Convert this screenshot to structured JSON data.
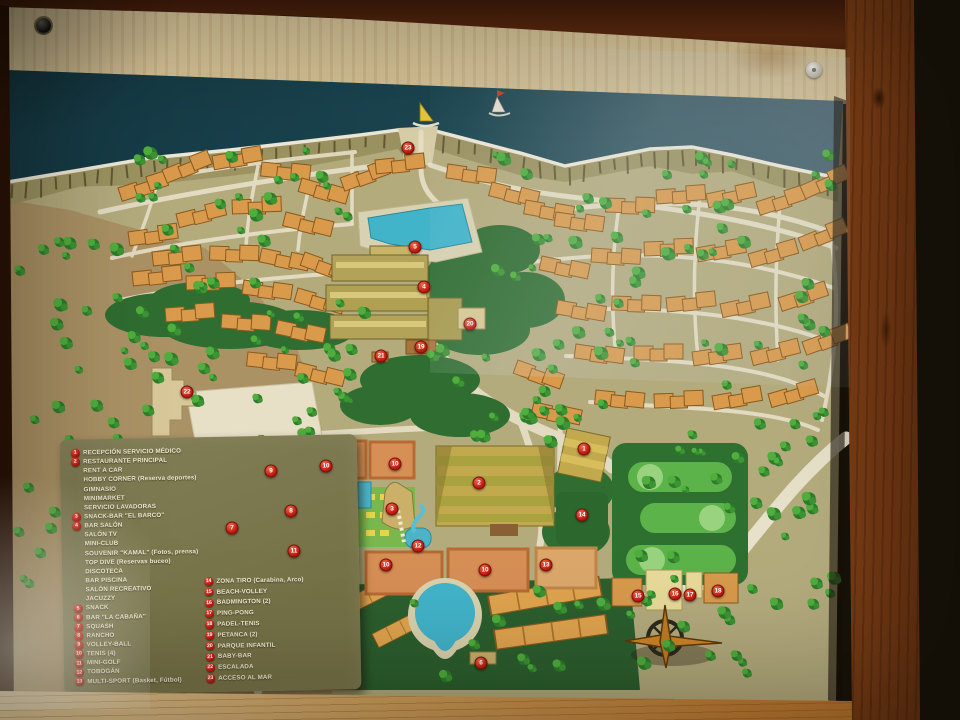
{
  "board": {
    "type": "resort-site-map-sign",
    "colors": {
      "sea_teal": "#1c4652",
      "land_olive": "#b4ab7d",
      "legend_olive": "#7a774f",
      "marker_red": "#c21d10",
      "building_orange": "#d99a4c",
      "pool_blue": "#42b4ca",
      "golf_green": "#2d7030",
      "wood_brown": "#a35d22"
    },
    "icons": [
      {
        "name": "compass-rose-icon"
      },
      {
        "name": "sailboat-yellow-icon"
      },
      {
        "name": "sailboat-white-icon"
      }
    ]
  },
  "legend": {
    "column1": [
      {
        "num": "1",
        "label": "RECEPCIÓN SERVICIO MÉDICO"
      },
      {
        "num": "2",
        "label": "RESTAURANTE PRINCIPAL"
      },
      {
        "num": "",
        "label": "RENT A CAR"
      },
      {
        "num": "",
        "label": "HOBBY CORNER (Reserva deportes)"
      },
      {
        "num": "",
        "label": "GIMNASIO"
      },
      {
        "num": "",
        "label": "MINIMARKET"
      },
      {
        "num": "",
        "label": "SERVICIO LAVADORAS"
      },
      {
        "num": "3",
        "label": "SNACK-BAR \"EL BARCO\""
      },
      {
        "num": "4",
        "label": "BAR SALÓN"
      },
      {
        "num": "",
        "label": "SALÓN TV"
      },
      {
        "num": "",
        "label": "MINI-CLUB"
      },
      {
        "num": "",
        "label": "SOUVENIR \"KAMAL\" (Fotos, prensa)"
      },
      {
        "num": "",
        "label": "TOP DIVE (Reservas buceo)"
      },
      {
        "num": "",
        "label": "DISCOTECA"
      },
      {
        "num": "",
        "label": "BAR PISCINA"
      },
      {
        "num": "",
        "label": "SALÓN RECREATIVO"
      },
      {
        "num": "",
        "label": "JACUZZY"
      },
      {
        "num": "5",
        "label": "SNACK"
      },
      {
        "num": "6",
        "label": "BAR \"LA CABAÑA\""
      },
      {
        "num": "7",
        "label": "SQUASH"
      },
      {
        "num": "8",
        "label": "RANCHO"
      },
      {
        "num": "9",
        "label": "VOLLEY-BALL"
      },
      {
        "num": "10",
        "label": "TENIS (4)"
      },
      {
        "num": "11",
        "label": "MINI-GOLF"
      },
      {
        "num": "12",
        "label": "TOBOGÁN"
      },
      {
        "num": "13",
        "label": "MULTI-SPORT (Basket, Fútbol)"
      }
    ],
    "column2": [
      {
        "num": "14",
        "label": "ZONA TIRO (Carabina, Arco)"
      },
      {
        "num": "15",
        "label": "BEACH-VOLLEY"
      },
      {
        "num": "16",
        "label": "BADMINGTON (2)"
      },
      {
        "num": "17",
        "label": "PING-PONG"
      },
      {
        "num": "18",
        "label": "PADEL-TENIS"
      },
      {
        "num": "19",
        "label": "PETANCA (2)"
      },
      {
        "num": "20",
        "label": "PARQUE INFANTIL"
      },
      {
        "num": "21",
        "label": "BABY-BAR"
      },
      {
        "num": "22",
        "label": "ESCALADA"
      },
      {
        "num": "23",
        "label": "ACCESO AL MAR"
      }
    ]
  },
  "map": {
    "markers": [
      {
        "num": "23",
        "x": 408,
        "y": 148
      },
      {
        "num": "5",
        "x": 415,
        "y": 247
      },
      {
        "num": "4",
        "x": 424,
        "y": 287
      },
      {
        "num": "20",
        "x": 470,
        "y": 324
      },
      {
        "num": "19",
        "x": 421,
        "y": 347
      },
      {
        "num": "21",
        "x": 381,
        "y": 356
      },
      {
        "num": "22",
        "x": 187,
        "y": 392
      },
      {
        "num": "1",
        "x": 584,
        "y": 449
      },
      {
        "num": "2",
        "x": 479,
        "y": 483
      },
      {
        "num": "14",
        "x": 582,
        "y": 515
      },
      {
        "num": "9",
        "x": 271,
        "y": 471
      },
      {
        "num": "10",
        "x": 326,
        "y": 466
      },
      {
        "num": "10",
        "x": 395,
        "y": 464
      },
      {
        "num": "7",
        "x": 232,
        "y": 528
      },
      {
        "num": "8",
        "x": 291,
        "y": 511
      },
      {
        "num": "3",
        "x": 392,
        "y": 509
      },
      {
        "num": "11",
        "x": 294,
        "y": 551
      },
      {
        "num": "12",
        "x": 418,
        "y": 546
      },
      {
        "num": "10",
        "x": 386,
        "y": 565
      },
      {
        "num": "10",
        "x": 485,
        "y": 570
      },
      {
        "num": "13",
        "x": 546,
        "y": 565
      },
      {
        "num": "15",
        "x": 638,
        "y": 596
      },
      {
        "num": "16",
        "x": 675,
        "y": 594
      },
      {
        "num": "17",
        "x": 690,
        "y": 595
      },
      {
        "num": "18",
        "x": 718,
        "y": 591
      },
      {
        "num": "6",
        "x": 481,
        "y": 663
      }
    ]
  }
}
